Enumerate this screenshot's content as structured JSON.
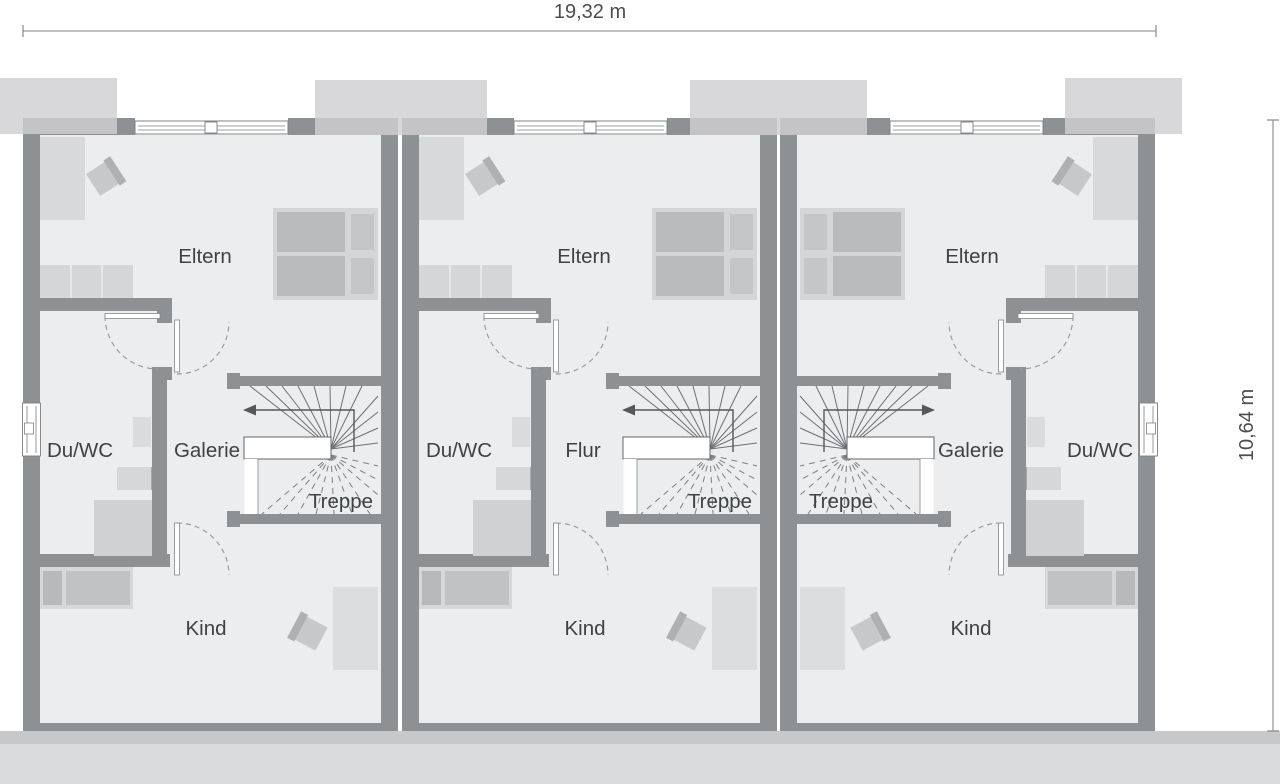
{
  "dimensions": {
    "width": "19,32 m",
    "height": "10,64 m"
  },
  "units": [
    {
      "id": "unit-1",
      "rooms": {
        "eltern": "Eltern",
        "bad": "Du/WC",
        "mitte": "Galerie",
        "treppe": "Treppe",
        "kind": "Kind"
      }
    },
    {
      "id": "unit-2",
      "rooms": {
        "eltern": "Eltern",
        "bad": "Du/WC",
        "mitte": "Flur",
        "treppe": "Treppe",
        "kind": "Kind"
      }
    },
    {
      "id": "unit-3",
      "rooms": {
        "eltern": "Eltern",
        "bad": "Du/WC",
        "mitte": "Galerie",
        "treppe": "Treppe",
        "kind": "Kind"
      }
    }
  ],
  "colors": {
    "wall": "#8e9194",
    "floor": "#ebedee",
    "furniture_light": "#d6d7d9",
    "furniture_dark": "#b9bbbd",
    "dormer": "#d7d8da",
    "ground_dark": "#c7c8ca",
    "ground_light": "#dadbdc",
    "label_text": "#3f4245",
    "dimension_line": "#9b9c9e"
  }
}
